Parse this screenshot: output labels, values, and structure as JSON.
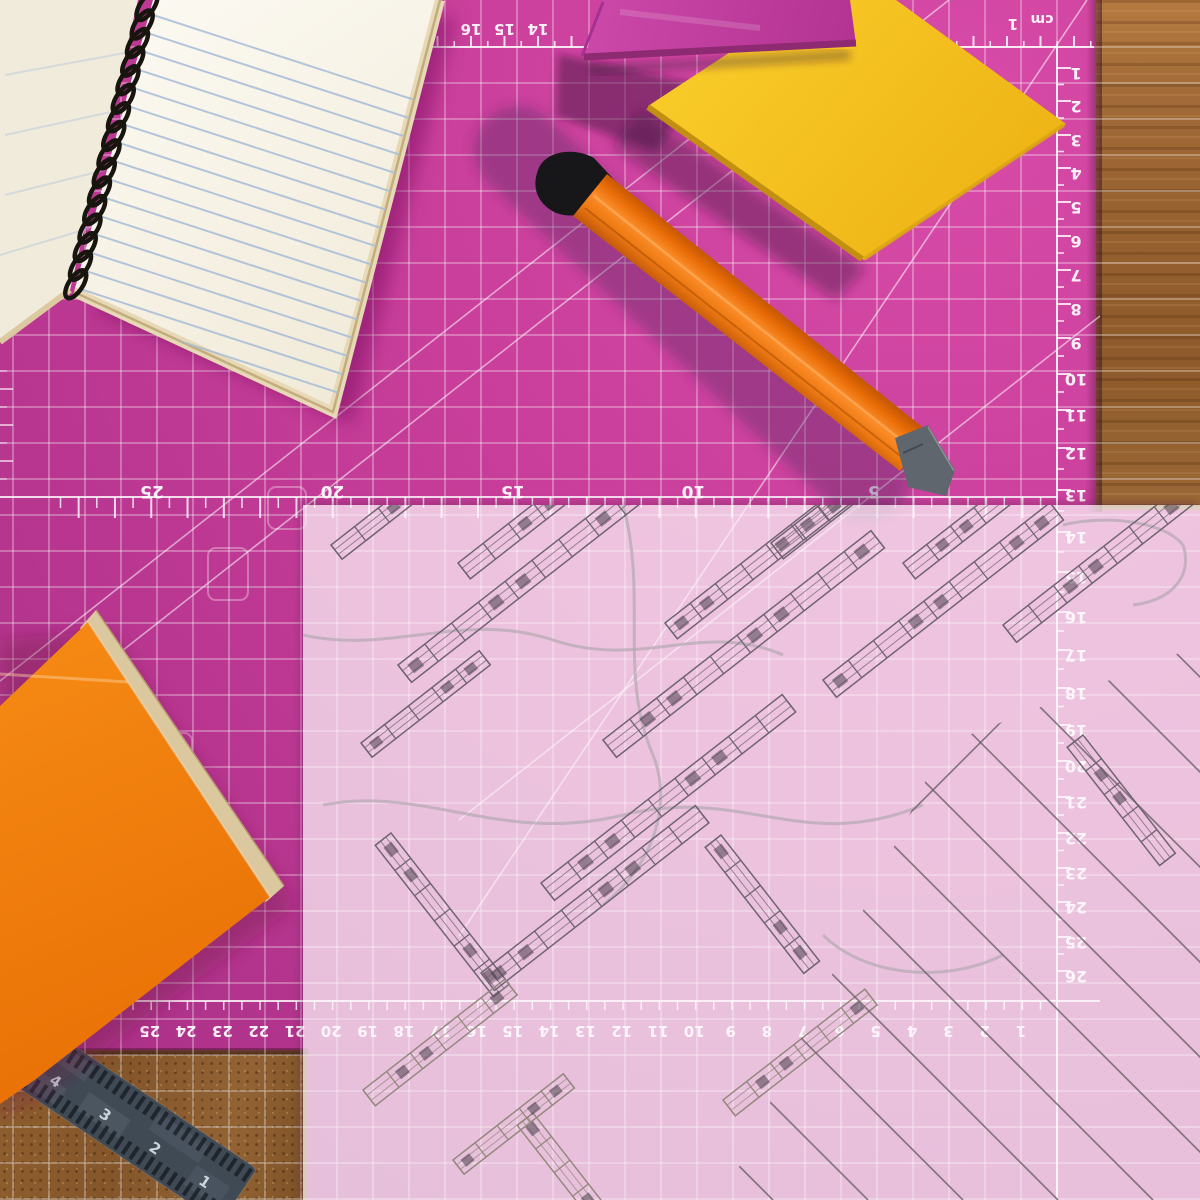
{
  "cutting_mat": {
    "color": "#c43d98",
    "grid_color": "#ffffff",
    "unit_label": "cm",
    "top_edge_numbers": [
      "16",
      "15",
      "14"
    ],
    "top_corner_number": "1",
    "right_edge_numbers": [
      "1",
      "2",
      "3",
      "4",
      "5",
      "6",
      "7",
      "8",
      "9",
      "10",
      "11",
      "12",
      "13",
      "14",
      "15",
      "16",
      "17",
      "18",
      "19",
      "20",
      "21",
      "22",
      "23",
      "24",
      "25",
      "26"
    ],
    "middle_scale_numbers": [
      "25",
      "20",
      "15",
      "10",
      "5"
    ],
    "bottom_edge_numbers": [
      "1",
      "2",
      "3",
      "4",
      "5",
      "6",
      "7",
      "8",
      "9",
      "10",
      "11",
      "12",
      "13",
      "14",
      "15",
      "16",
      "17",
      "18",
      "19",
      "20",
      "21",
      "22",
      "23",
      "24",
      "25"
    ]
  },
  "steel_ruler": {
    "color": "#404a55",
    "numbers": [
      "4",
      "3",
      "2",
      "1"
    ]
  },
  "notebook": {
    "paper_color": "#f7f3e8",
    "line_color": "#a6bdd6",
    "spiral_color": "#18150f"
  },
  "sticky_notes": {
    "magenta_color": "#bf3a9e",
    "yellow_color": "#f5c31b"
  },
  "utility_knife": {
    "handle_color": "#f57d15",
    "cap_color": "#17171a",
    "blade_color": "#5f666e"
  },
  "orange_notebook": {
    "cover_color": "#ef7d12",
    "page_edge_color": "#dcc89e"
  },
  "desk": {
    "wood_color": "#9a6233"
  },
  "blueprint": {
    "paper_tint": "rgba(252,247,250,0.72)",
    "ink_color": "#6f6472"
  }
}
